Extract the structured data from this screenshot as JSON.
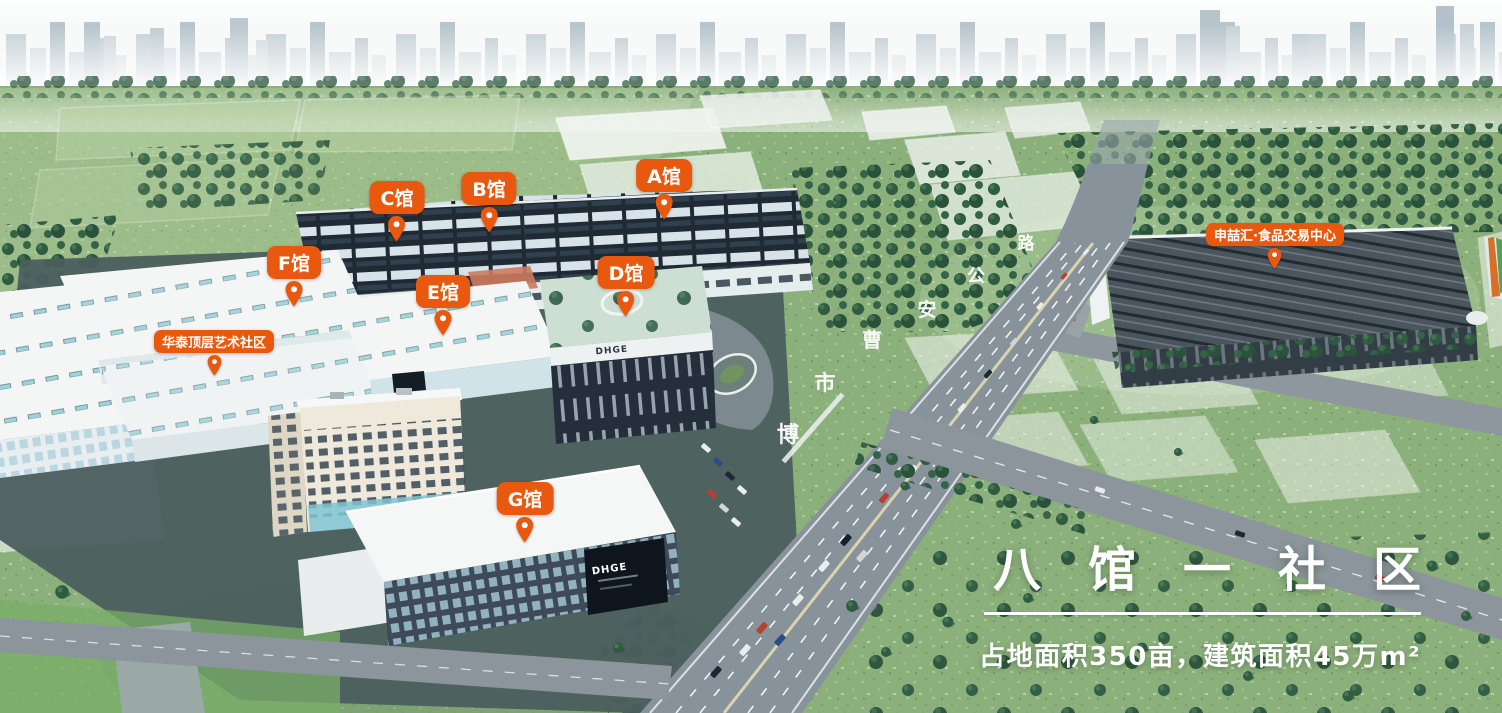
{
  "scene": {
    "accent": "#E8590F",
    "title": "八馆一社区",
    "subtitle": "占地面积350亩，建筑面积45万m²"
  },
  "pins": [
    {
      "id": "a-hall",
      "label": "A馆"
    },
    {
      "id": "b-hall",
      "label": "B馆"
    },
    {
      "id": "c-hall",
      "label": "C馆"
    },
    {
      "id": "d-hall",
      "label": "D馆"
    },
    {
      "id": "e-hall",
      "label": "E馆"
    },
    {
      "id": "f-hall",
      "label": "F馆"
    },
    {
      "id": "g-hall",
      "label": "G馆"
    },
    {
      "id": "huatai-community",
      "label": "华泰顶层艺术社区"
    },
    {
      "id": "shenzhehui-center",
      "label": "申喆汇·食品交易中心"
    }
  ],
  "road_name": {
    "chars": [
      "博",
      "市",
      "曹",
      "安",
      "公",
      "路"
    ]
  },
  "logos": {
    "d_hall": "DHGE",
    "g_hall": "DHGE"
  }
}
